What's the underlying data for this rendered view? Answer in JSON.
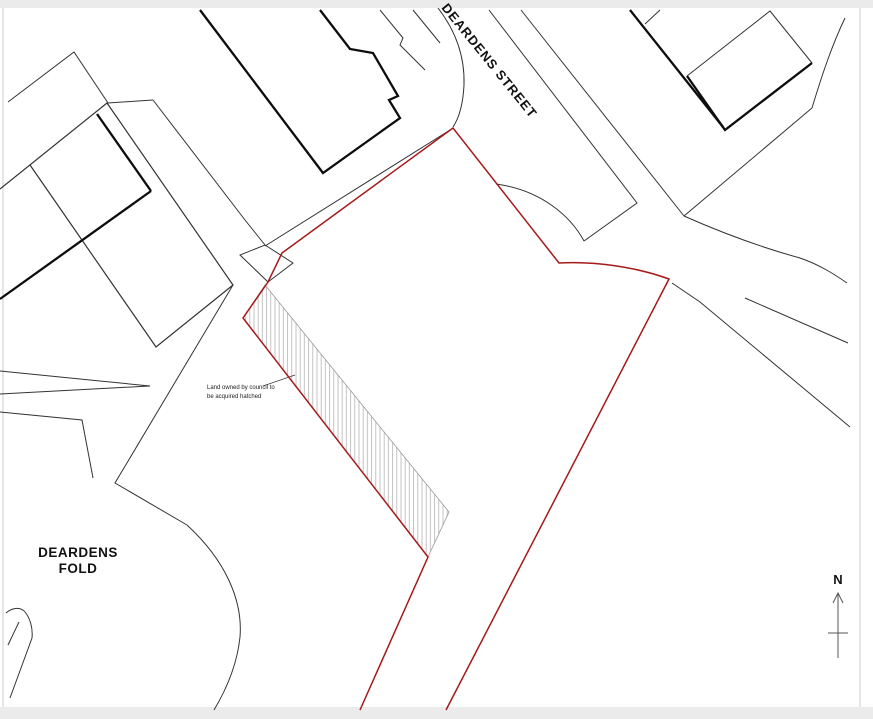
{
  "labels": {
    "street": "DEARDENS STREET",
    "fold_line1": "DEARDENS",
    "fold_line2": "FOLD",
    "annotation_line1": "Land owned by council to",
    "annotation_line2": "be acquired hatched",
    "north": "N"
  },
  "colors": {
    "boundary_red": "#a51919",
    "thin_line": "#333333",
    "thick_line": "#0d0d0d",
    "hatch_gray": "#b3b3b3",
    "hatch_edge": "#9a9a9a",
    "frame_gray": "#cccccc",
    "strip_gray": "#ebebeb",
    "north_arrow": "#555555"
  },
  "map": {
    "hatch_area": "M265,285 L449,512 L428,557 L243,318 Z",
    "red_boundary": "M360,710 L428,557 L243,318 L268,282 L282,253 L453,128 L559,263 C595,261 636,267 669,279 L446,710",
    "thin_paths": [
      {
        "name": "parcel-wedge-nw",
        "d": "M8,102 L74,52 L108,103 L153,100",
        "w": 1
      },
      {
        "name": "parcel-block-west",
        "d": "M0,189 L107,103 L233,285 L156,347 L30,165",
        "w": 1.2
      },
      {
        "name": "street-edge-nw",
        "d": "M153,100 L245,220 L265,245",
        "w": 1
      },
      {
        "name": "street-island",
        "d": "M265,245 L293,263 L268,282 L240,255 Z",
        "w": 1
      },
      {
        "name": "fold-street-west-edge",
        "d": "M233,285 L115,483 L187,525",
        "w": 1
      },
      {
        "name": "fold-street-arc",
        "d": "M187,525 C225,560 243,600 240,637 C237,666 226,690 214,710",
        "w": 1
      },
      {
        "name": "fold-corner-wedge-upper",
        "d": "M0,371 L150,386 L0,394",
        "w": 1
      },
      {
        "name": "fold-corner-wedge-lower",
        "d": "M0,412 L82,420 L93,478",
        "w": 1
      },
      {
        "name": "corner-curve-sw",
        "d": "M6,613 C13,607 21,607 25,612 C30,618 33,628 32,638 L10,698",
        "w": 1
      },
      {
        "name": "corner-curve-sw-inner",
        "d": "M19,622 L8,645",
        "w": 1
      },
      {
        "name": "deardens-street-east-edge",
        "d": "M489,10 L637,203 L584,241",
        "w": 1
      },
      {
        "name": "street-corner-curve",
        "d": "M496,184 C540,190 570,215 584,241",
        "w": 1
      },
      {
        "name": "deardens-street-west-curve",
        "d": "M438,8 C455,30 465,55 464,85 C463,105 459,118 453,127",
        "w": 1
      },
      {
        "name": "site-north-black-edge",
        "d": "M450,130 L265,246",
        "w": 1
      },
      {
        "name": "road-north-edge",
        "d": "M521,10 L684,216",
        "w": 1
      },
      {
        "name": "road-curve-east",
        "d": "M684,216 C720,232 760,247 800,258 C820,265 834,274 847,283",
        "w": 1
      },
      {
        "name": "road-ne-edge",
        "d": "M845,18 C832,45 822,75 812,108 L684,216",
        "w": 1
      },
      {
        "name": "road-south-edge",
        "d": "M745,298 L848,343",
        "w": 1
      },
      {
        "name": "road-se-edge",
        "d": "M672,283 L700,302 L850,427",
        "w": 1
      },
      {
        "name": "alley-line-west",
        "d": "M380,10 L403,38 L400,45 L425,70",
        "w": 1
      },
      {
        "name": "alley-line-east",
        "d": "M413,10 L440,43",
        "w": 1
      },
      {
        "name": "building-ne-outline-thin",
        "d": "M687,76 L770,11 L812,63",
        "w": 1
      },
      {
        "name": "building-ne-spur",
        "d": "M645,24 L660,10",
        "w": 1
      },
      {
        "name": "annotation-leader",
        "d": "M263,386 L295,375",
        "w": 0.7
      }
    ],
    "thick_paths": [
      {
        "name": "building-main-outline",
        "d": "M200,10 L323,173 L400,118 L389,100 L398,96 L373,53 L350,49 L320,10"
      },
      {
        "name": "building-ne-outline-thick",
        "d": "M812,63 L725,130 L687,76"
      },
      {
        "name": "boundary-wall-ne",
        "d": "M630,10 L723,127"
      },
      {
        "name": "boundary-wall-west-a",
        "d": "M97,114 L151,191"
      },
      {
        "name": "boundary-wall-west-b",
        "d": "M151,191 L0,299"
      }
    ]
  }
}
